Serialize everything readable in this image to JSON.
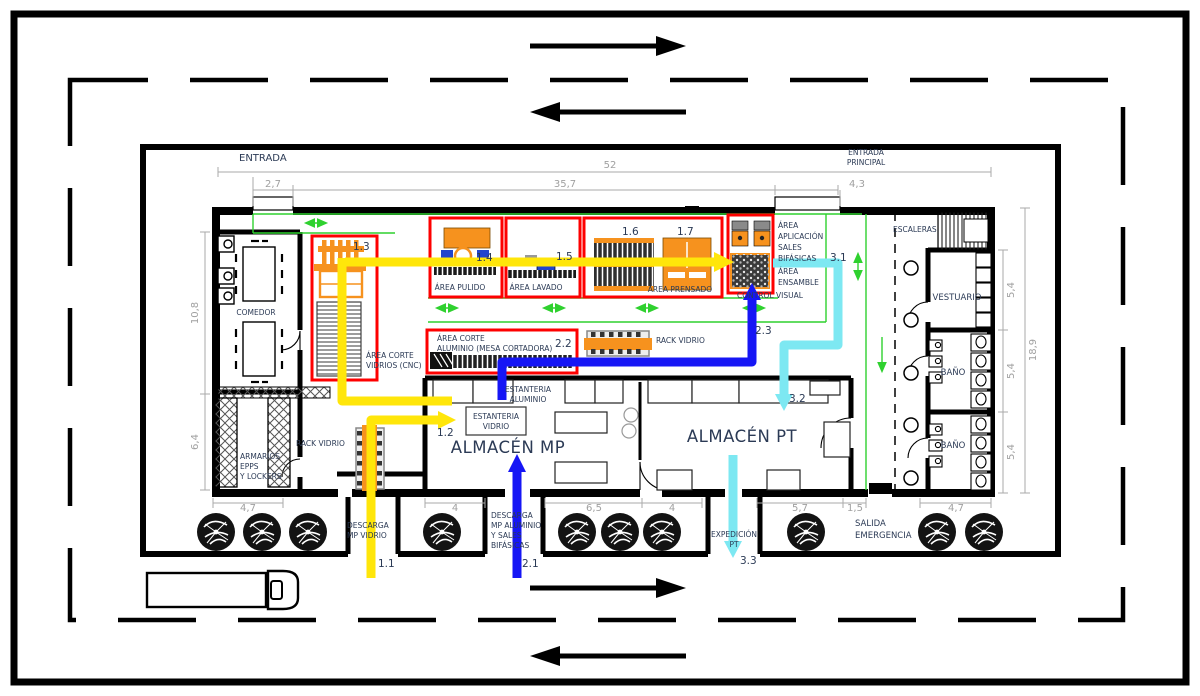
{
  "rooms": {
    "comedor": "COMEDOR",
    "armarios": [
      "ARMARIOS",
      "EPPS",
      "Y LOCKERS"
    ],
    "vestuario": "VESTUARIO",
    "bano_1": "BAÑO",
    "bano_2": "BAÑO",
    "escaleras": "ESCALERAS",
    "almacen_mp": "ALMACÉN MP",
    "almacen_pt": "ALMACÉN PT"
  },
  "areas": {
    "corte_vidrios": [
      "ÁREA CORTE",
      "VIDRIOS (CNC)"
    ],
    "pulido": "ÁREA PULIDO",
    "lavado": "ÁREA LAVADO",
    "prensado": "ÁREA PRENSADO",
    "corte_aluminio": [
      "ÁREA CORTE",
      "ALUMINIO (MESA CORTADORA)"
    ],
    "aplicacion": [
      "ÁREA",
      "APLICACIÓN",
      "SALES",
      "BIFÁSICAS"
    ],
    "ensamble": [
      "ÁREA",
      "ENSAMBLE"
    ],
    "control_visual": "CONTROL VISUAL"
  },
  "storage": {
    "rack_vidrio_top": "RACK VIDRIO",
    "rack_vidrio_left": "RACK VIDRIO",
    "estanteria_aluminio": [
      "ESTANTERIA",
      "ALUMINIO"
    ],
    "estanteria_vidrio": [
      "ESTANTERIA",
      "VIDRIO"
    ]
  },
  "accesses": {
    "entrada": "ENTRADA",
    "entrada_principal": [
      "ENTRADA",
      "PRINCIPAL"
    ],
    "descarga_vidrio": [
      "DESCARGA",
      "MP VIDRIO"
    ],
    "descarga_aluminio": [
      "DESCARGA",
      "MP ALUMINIO",
      "Y SALES",
      "BIFÁSICAS"
    ],
    "expedicion": [
      "EXPEDICIÓN",
      "PT"
    ],
    "salida_emergencia": [
      "SALIDA",
      "EMERGENCIA"
    ]
  },
  "flow_points": {
    "f1_1": "1.1",
    "f1_2": "1.2",
    "f1_3": "1.3",
    "f1_4": "1.4",
    "f1_5": "1.5",
    "f1_6": "1.6",
    "f1_7": "1.7",
    "f2_1": "2.1",
    "f2_2": "2.2",
    "f2_3": "2.3",
    "f3_1": "3.1",
    "f3_2": "3.2",
    "f3_3": "3.3"
  },
  "dimensions": {
    "top_total": "52",
    "top_door_entrada": "2,7",
    "top_production": "35,7",
    "top_door_principal": "4,3",
    "left_upper": "10,8",
    "left_lower": "6,4",
    "right_vestuario": "5,4",
    "right_bano1": "5,4",
    "right_bano2": "5,4",
    "right_total": "18,9",
    "bottom_1": "4,7",
    "bottom_2": "4",
    "bottom_3": "6,5",
    "bottom_4": "4",
    "bottom_5": "5,7",
    "bottom_6": "1,5",
    "bottom_7": "4,7"
  },
  "colors": {
    "flow_vidrio": "#ffe60a",
    "flow_aluminio": "#1616f5",
    "flow_producto": "#7de8f2",
    "area_highlight": "#fe0000",
    "machinery": "#f6921e",
    "route_guide": "#2fd12f"
  }
}
